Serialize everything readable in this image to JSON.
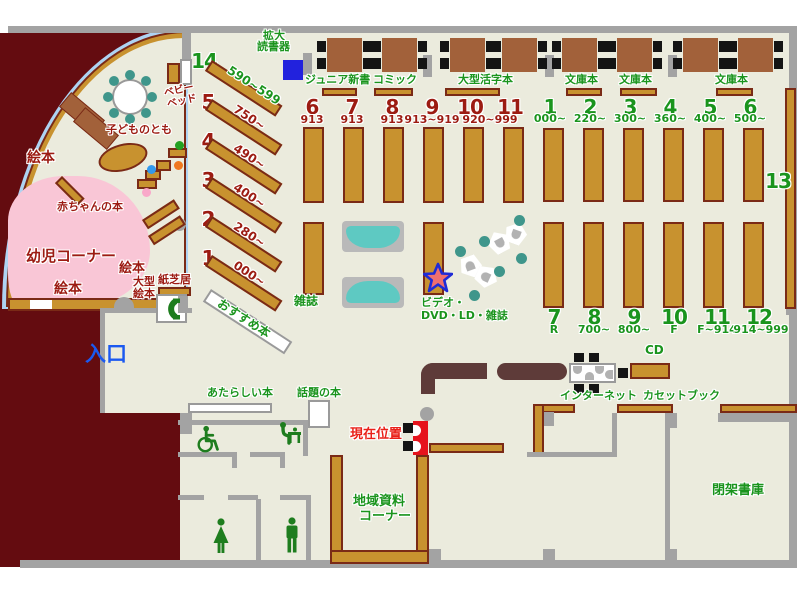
{
  "colors": {
    "floor": "#ebebdd",
    "wall": "#a3a3a3",
    "maroon": "#640c10",
    "shelf_tan": "#c8922f",
    "shelf_border": "#7a2a16",
    "table_brown": "#a2613a",
    "counter_brown": "#5e3b39",
    "sofa_teal": "#5ec9c2",
    "chair_teal": "#3f968b",
    "pink_area": "#f9c6d6",
    "glass_blue": "#aed3f2",
    "green_text": "#1a941d",
    "dark_red_text": "#9c1b12",
    "blue_text": "#1b59f0",
    "red_text": "#e92018",
    "marker_red": "#e6131c",
    "device_blue": "#2222dd"
  },
  "top_area": {
    "magnifier_l1": "拡大",
    "magnifier_l2": "読書器",
    "junior_shinsho": "ジュニア新書",
    "comic": "コミック",
    "large_print": "大型活字本",
    "bunko_1": "文庫本",
    "bunko_2": "文庫本",
    "bunko_3": "文庫本"
  },
  "left_shelves": [
    {
      "num": "14",
      "range": "590~599"
    },
    {
      "num": "5",
      "range": "750~"
    },
    {
      "num": "4",
      "range": "490~"
    },
    {
      "num": "3",
      "range": "400~"
    },
    {
      "num": "2",
      "range": "280~"
    },
    {
      "num": "1",
      "range": "000~"
    }
  ],
  "mid_group": {
    "items": [
      {
        "num": "6",
        "range": "913"
      },
      {
        "num": "7",
        "range": "913"
      },
      {
        "num": "8",
        "range": "913"
      },
      {
        "num": "9",
        "range": "913~919"
      },
      {
        "num": "10"
      },
      {
        "num": "11"
      }
    ],
    "range_10_11": "920~999"
  },
  "right_top": [
    {
      "num": "1",
      "range": "000~"
    },
    {
      "num": "2",
      "range": "220~"
    },
    {
      "num": "3",
      "range": "300~"
    },
    {
      "num": "4",
      "range": "360~"
    },
    {
      "num": "5",
      "range": "400~"
    },
    {
      "num": "6",
      "range": "500~"
    }
  ],
  "right_bottom": [
    {
      "num": "7",
      "range": "R"
    },
    {
      "num": "8",
      "range": "700~"
    },
    {
      "num": "9",
      "range": "800~"
    },
    {
      "num": "10",
      "range": "F"
    },
    {
      "num": "11",
      "range": "F~914"
    },
    {
      "num": "12",
      "range": "914~999"
    }
  ],
  "shelf_13": "13",
  "kids_area": {
    "ehon_top": "絵本",
    "ehon_mid": "絵本",
    "ehon_bottom": "絵本",
    "baby_books": "赤ちゃんの本",
    "kodomo_no_tomo": "子どものとも",
    "kids_corner": "幼児コーナー",
    "baby_bed_l1": "ベビー",
    "baby_bed_l2": "ベッド",
    "large_ehon_l1": "大型",
    "large_ehon_l2": "絵本",
    "kamishibai": "紙芝居"
  },
  "labels": {
    "entrance": "入口",
    "magazines": "雑誌",
    "recommended": "おすすめ本",
    "video_l1": "ビデオ・",
    "video_l2": "DVD・LD・雑誌",
    "new_books": "あたらしい本",
    "topic_books": "話題の本",
    "internet": "インターネット",
    "cd": "CD",
    "cassette_book": "カセットブック",
    "closed_stacks": "閉架書庫",
    "local_materials_l1": "地域資料",
    "local_materials_l2": "コーナー",
    "current_location": "現在位置"
  }
}
